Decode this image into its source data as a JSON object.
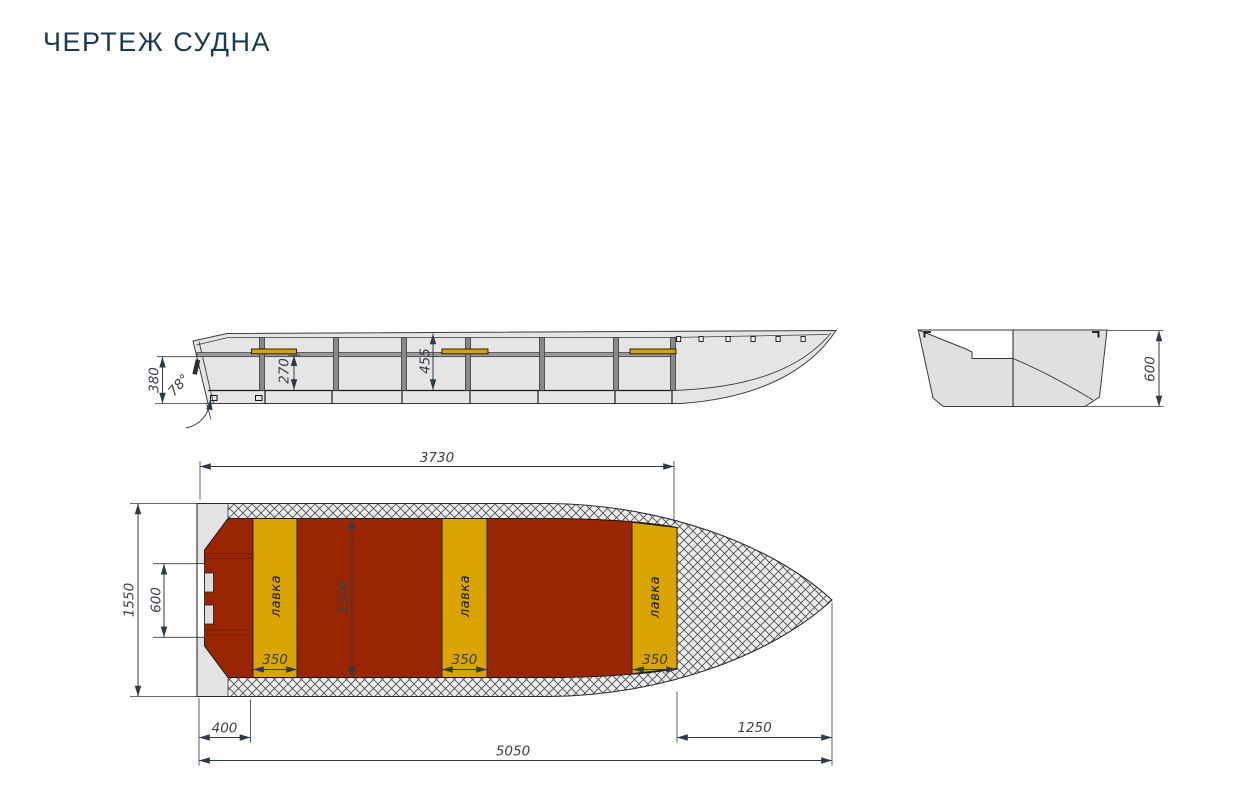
{
  "page": {
    "title": "ЧЕРТЕЖ СУДНА"
  },
  "colors": {
    "title_text": "#1c3952",
    "floor_red": "#992600",
    "bench_yellow": "#d9a400",
    "hull_gray": "#e5e5e5",
    "frame_gray": "#898989",
    "dimension_text": "#39424d"
  },
  "views": {
    "side": {
      "stern_height": "380",
      "transom_angle": "78°",
      "bench_height": "270",
      "inner_depth": "455"
    },
    "section": {
      "board_height": "600"
    },
    "plan": {
      "cockpit_length": "3730",
      "overall_width": "1550",
      "transom_recess_width": "600",
      "floor_width": "1300",
      "benches": [
        {
          "label": "лавка",
          "width": "350"
        },
        {
          "label": "лавка",
          "width": "350"
        },
        {
          "label": "лавка",
          "width": "350"
        }
      ],
      "stern_to_first_bench": "400",
      "bow_deck_length": "1250",
      "overall_length": "5050"
    }
  }
}
